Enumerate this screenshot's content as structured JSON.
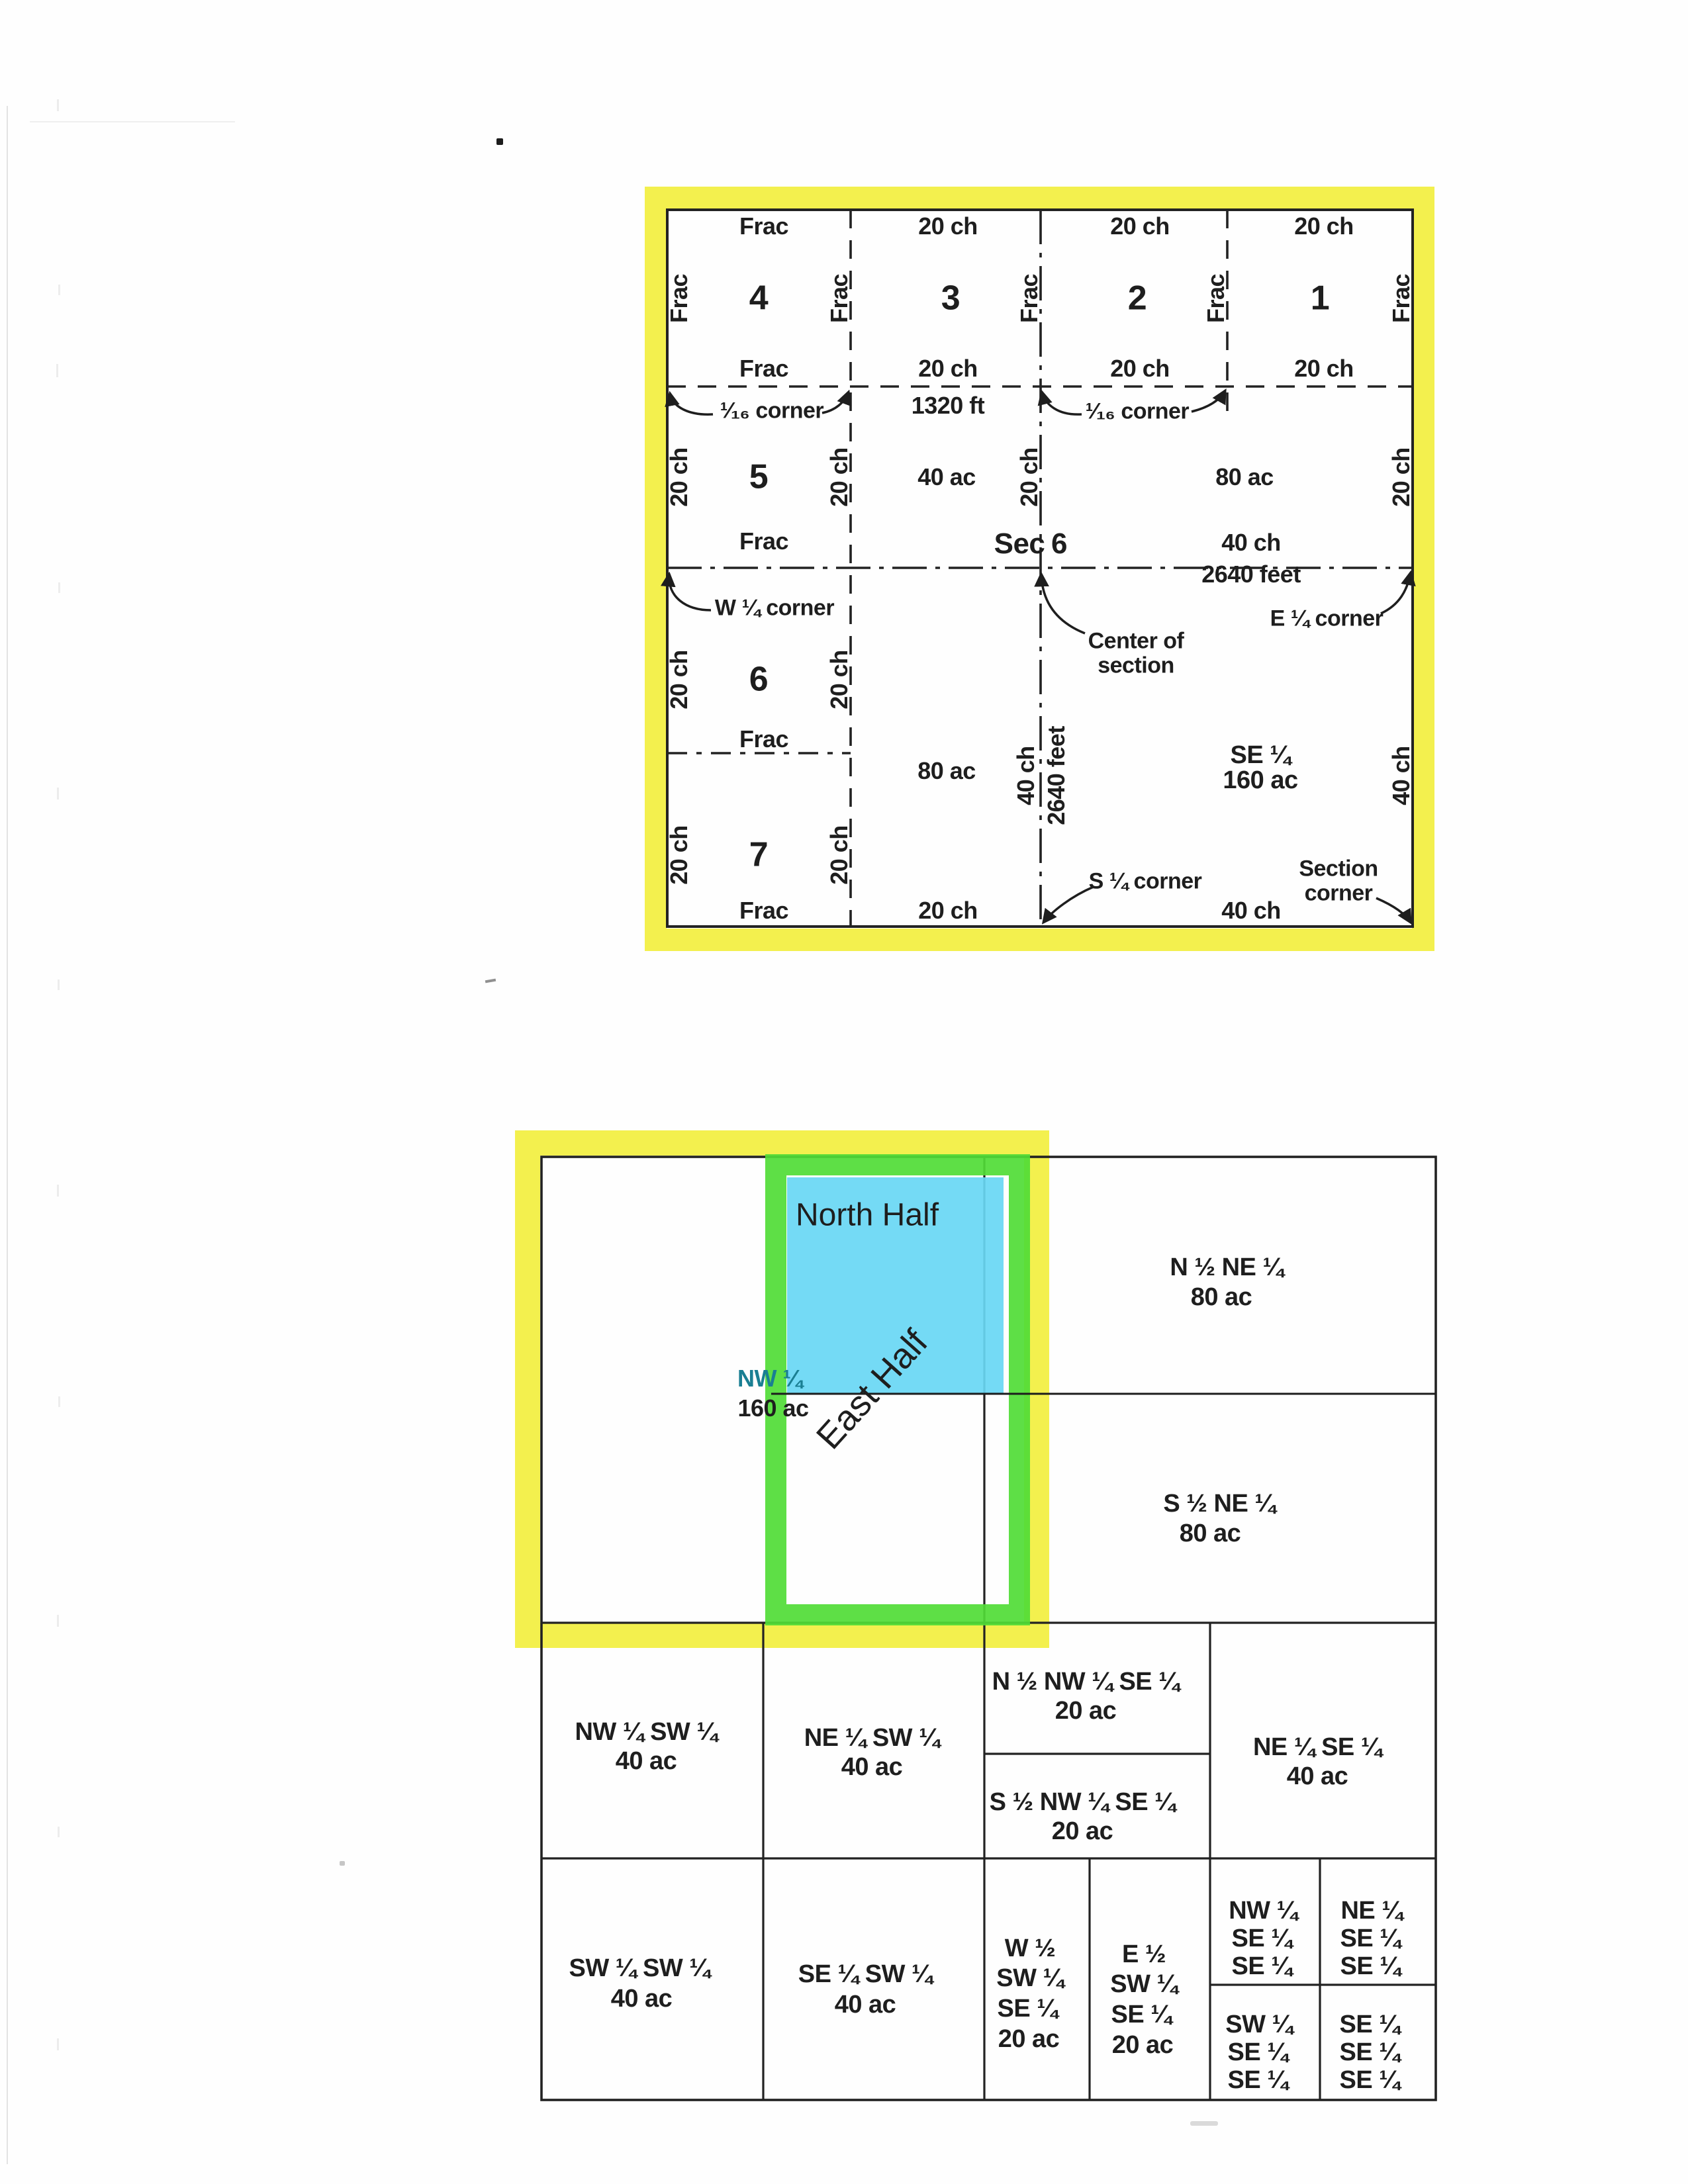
{
  "colors": {
    "highlight_yellow": "#f2ef44",
    "highlight_green": "#50dc36",
    "highlight_blue": "#68d7f4",
    "teal_label": "#1a7f93",
    "ink": "#1e1e1e"
  },
  "top": {
    "frac": "Frac",
    "ch20": "20 ch",
    "ch40": "40 ch",
    "ac40": "40 ac",
    "ac80": "80 ac",
    "ac160": "160 ac",
    "ft1320": "1320 ft",
    "ft2640": "2640 feet",
    "se_quarter": "SE ¼",
    "sec": "Sec",
    "sec_num": "6",
    "lots": [
      "1",
      "2",
      "3",
      "4",
      "5",
      "6",
      "7"
    ],
    "corner_sixteenth": "¹⁄₁₆ corner",
    "corner_w": "W ¼ corner",
    "corner_e": "E ¼ corner",
    "corner_s": "S ¼ corner",
    "corner_section": "Section corner",
    "center_of_section": "Center of section"
  },
  "bottom": {
    "north_half": "North Half",
    "east_half": "East Half",
    "nw_quarter": "NW ¼",
    "ac160": "160 ac",
    "ac80": "80 ac",
    "ac40": "40 ac",
    "ac20": "20 ac",
    "n2_ne": "N ½ NE ¼",
    "s2_ne": "S ½ NE ¼",
    "nw_sw": "NW ¼ SW ¼",
    "ne_sw": "NE ¼ SW ¼",
    "sw_sw": "SW ¼ SW ¼",
    "se_sw": "SE ¼ SW ¼",
    "n2_nw_se": "N ½ NW ¼ SE ¼",
    "s2_nw_se": "S ½ NW ¼ SE ¼",
    "ne_se": "NE ¼ SE ¼",
    "w_half": "W ½",
    "e_half": "E ½",
    "sw_quarter": "SW ¼",
    "se_quarter": "SE ¼",
    "ne_quarter": "NE ¼"
  }
}
